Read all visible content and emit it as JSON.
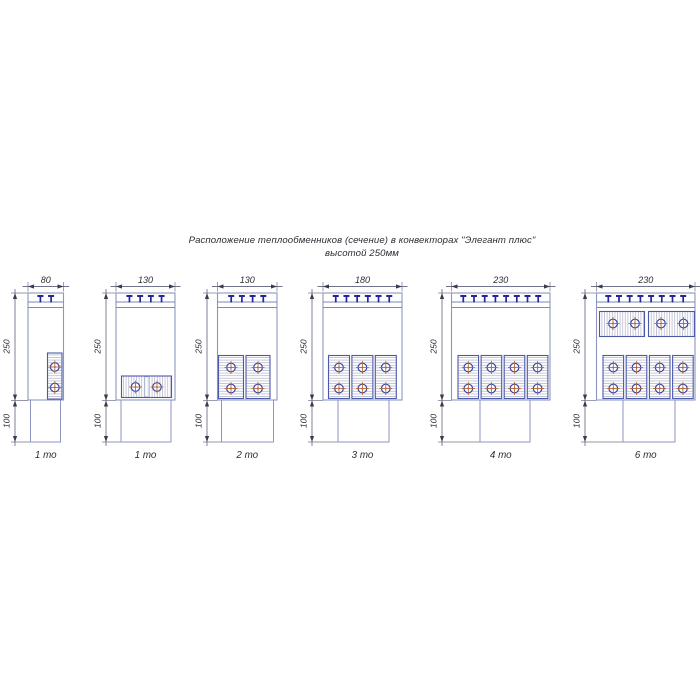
{
  "title": {
    "line1": "Расположение теплообменников (сечение) в конвекторах \"Элегант плюс\"",
    "line2": "высотой 250мм"
  },
  "colors": {
    "background": "#ffffff",
    "outline": "#8d96c0",
    "grille": "#7d87b8",
    "clip": "#23279b",
    "block_border": "#4e58a8",
    "hatch": "#b8bcce",
    "circle_ring": "#3a45a2",
    "cross": "#b5683c",
    "dim_line": "#70748a",
    "dim_arrow": "#3c3c46",
    "dim_text": "#2c2c34"
  },
  "drawing": {
    "body_top": 293,
    "body_bottom": 400,
    "duct_bottom": 442,
    "grille_lines": [
      302,
      307.5
    ],
    "clip_cap_y": 296,
    "clip_stem_bottom": 302.5,
    "clip_spacing": 10.7,
    "top_dim_y": 286.5,
    "top_label_y": 283,
    "label_250_y": 346.5,
    "label_100_y": 421,
    "bottom_label_y": 458
  },
  "units": [
    {
      "name": "convector-80-1to",
      "width_mm": 80,
      "height_mm": 250,
      "foot_mm": 100,
      "dim_width_label": "80",
      "dim_height_label": "250",
      "dim_foot_label": "100",
      "label": "1 то",
      "px": {
        "dim_x": 15,
        "body_x": 28,
        "body_w": 35.5,
        "duct_x": 30.5,
        "duct_w": 30,
        "clips": 2,
        "blocks": [
          {
            "x": 47.5,
            "y": 353,
            "w": 14.5,
            "h": 46,
            "hatch": "h",
            "circles": [
              [
                54.8,
                367
              ],
              [
                54.8,
                387.5
              ]
            ]
          }
        ]
      }
    },
    {
      "name": "convector-130-1to",
      "width_mm": 130,
      "height_mm": 250,
      "foot_mm": 100,
      "dim_width_label": "130",
      "dim_height_label": "250",
      "dim_foot_label": "100",
      "label": "1 то",
      "px": {
        "dim_x": 106,
        "body_x": 116,
        "body_w": 59,
        "duct_x": 121,
        "duct_w": 50,
        "clips": 4,
        "blocks": [
          {
            "x": 121.5,
            "y": 376,
            "w": 50,
            "h": 21.5,
            "hatch": "v",
            "seam": 146.5,
            "circles": [
              [
                135.5,
                387
              ],
              [
                157,
                387
              ]
            ]
          }
        ]
      }
    },
    {
      "name": "convector-130-2to",
      "width_mm": 130,
      "height_mm": 250,
      "foot_mm": 100,
      "dim_width_label": "130",
      "dim_height_label": "250",
      "dim_foot_label": "100",
      "label": "2 то",
      "px": {
        "dim_x": 207,
        "body_x": 217.5,
        "body_w": 59.5,
        "duct_x": 221.5,
        "duct_w": 52,
        "clips": 4,
        "blocks": [
          {
            "x": 218.5,
            "y": 355.5,
            "w": 25,
            "h": 43,
            "hatch": "h",
            "circles": [
              [
                231,
                367.5
              ],
              [
                231,
                388.5
              ]
            ]
          },
          {
            "x": 246,
            "y": 355.5,
            "w": 24,
            "h": 43,
            "hatch": "h",
            "circles": [
              [
                258,
                367.5
              ],
              [
                258,
                388.5
              ]
            ]
          }
        ]
      }
    },
    {
      "name": "convector-180-3to",
      "width_mm": 180,
      "height_mm": 250,
      "foot_mm": 100,
      "dim_width_label": "180",
      "dim_height_label": "250",
      "dim_foot_label": "100",
      "label": "3 то",
      "px": {
        "dim_x": 312,
        "body_x": 323,
        "body_w": 79,
        "duct_x": 338,
        "duct_w": 51,
        "clips": 6,
        "blocks": [
          {
            "x": 328.5,
            "y": 355.5,
            "w": 21,
            "h": 43,
            "hatch": "h",
            "circles": [
              [
                339,
                367.5
              ],
              [
                339,
                388.5
              ]
            ]
          },
          {
            "x": 351.9,
            "y": 355.5,
            "w": 21,
            "h": 43,
            "hatch": "h",
            "circles": [
              [
                362.4,
                367.5
              ],
              [
                362.4,
                388.5
              ]
            ]
          },
          {
            "x": 375.3,
            "y": 355.5,
            "w": 21,
            "h": 43,
            "hatch": "h",
            "circles": [
              [
                385.8,
                367.5
              ],
              [
                385.8,
                388.5
              ]
            ]
          }
        ]
      }
    },
    {
      "name": "convector-230-4to",
      "width_mm": 230,
      "height_mm": 250,
      "foot_mm": 100,
      "dim_width_label": "230",
      "dim_height_label": "250",
      "dim_foot_label": "100",
      "label": "4 то",
      "px": {
        "dim_x": 442,
        "body_x": 451.5,
        "body_w": 98.5,
        "duct_x": 480,
        "duct_w": 50,
        "clips": 8,
        "blocks": [
          {
            "x": 458,
            "y": 355.5,
            "w": 20.6,
            "h": 43,
            "hatch": "h",
            "circles": [
              [
                468.3,
                367.5
              ],
              [
                468.3,
                388.5
              ]
            ]
          },
          {
            "x": 481.1,
            "y": 355.5,
            "w": 20.6,
            "h": 43,
            "hatch": "h",
            "circles": [
              [
                491.4,
                367.5
              ],
              [
                491.4,
                388.5
              ]
            ]
          },
          {
            "x": 504.2,
            "y": 355.5,
            "w": 20.6,
            "h": 43,
            "hatch": "h",
            "circles": [
              [
                514.5,
                367.5
              ],
              [
                514.5,
                388.5
              ]
            ]
          },
          {
            "x": 527.3,
            "y": 355.5,
            "w": 20.6,
            "h": 43,
            "hatch": "h",
            "circles": [
              [
                537.6,
                367.5
              ],
              [
                537.6,
                388.5
              ]
            ]
          }
        ]
      }
    },
    {
      "name": "convector-230-6to",
      "width_mm": 230,
      "height_mm": 250,
      "foot_mm": 100,
      "dim_width_label": "230",
      "dim_height_label": "250",
      "dim_foot_label": "100",
      "label": "6 то",
      "px": {
        "dim_x": 585,
        "body_x": 596.5,
        "body_w": 98.5,
        "duct_x": 623,
        "duct_w": 52,
        "clips": 8,
        "blocks": [
          {
            "x": 599.5,
            "y": 311.5,
            "w": 45,
            "h": 25,
            "hatch": "v",
            "circles": [
              [
                613,
                323.5
              ],
              [
                635,
                323.5
              ]
            ]
          },
          {
            "x": 648.5,
            "y": 311.5,
            "w": 46,
            "h": 25,
            "hatch": "v",
            "circles": [
              [
                661,
                323.5
              ],
              [
                683.5,
                323.5
              ]
            ]
          },
          {
            "x": 603,
            "y": 355.5,
            "w": 20.6,
            "h": 43,
            "hatch": "h",
            "circles": [
              [
                613.3,
                367.5
              ],
              [
                613.3,
                388.5
              ]
            ]
          },
          {
            "x": 626.2,
            "y": 355.5,
            "w": 20.6,
            "h": 43,
            "hatch": "h",
            "circles": [
              [
                636.5,
                367.5
              ],
              [
                636.5,
                388.5
              ]
            ]
          },
          {
            "x": 649.4,
            "y": 355.5,
            "w": 20.6,
            "h": 43,
            "hatch": "h",
            "circles": [
              [
                659.7,
                367.5
              ],
              [
                659.7,
                388.5
              ]
            ]
          },
          {
            "x": 672.6,
            "y": 355.5,
            "w": 20.6,
            "h": 43,
            "hatch": "h",
            "circles": [
              [
                682.9,
                367.5
              ],
              [
                682.9,
                388.5
              ]
            ]
          }
        ]
      }
    }
  ]
}
